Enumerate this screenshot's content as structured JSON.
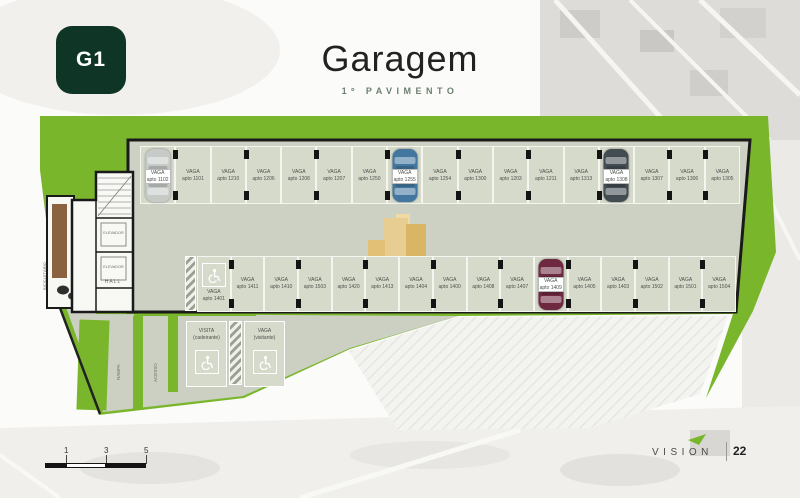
{
  "badge": {
    "label": "G1"
  },
  "header": {
    "title": "Garagem",
    "subtitle": "1º PAVIMENTO"
  },
  "plan": {
    "spot_word": "VAGA",
    "apto_prefix": "apto",
    "annex": {
      "elevator_label": "ELEVADOR",
      "hall_label": "HALL",
      "dock_label": "BICICLETÁRIO"
    },
    "lane_labels": [
      "RAMPA",
      "ACESSO"
    ],
    "rows": {
      "top": [
        {
          "apto": "1102",
          "car": "silver"
        },
        {
          "apto": "1101"
        },
        {
          "apto": "1210"
        },
        {
          "apto": "1206"
        },
        {
          "apto": "1208"
        },
        {
          "apto": "1207"
        },
        {
          "apto": "1250"
        },
        {
          "apto": "1255",
          "car": "blue"
        },
        {
          "apto": "1254"
        },
        {
          "apto": "1300"
        },
        {
          "apto": "1203"
        },
        {
          "apto": "1211"
        },
        {
          "apto": "1313"
        },
        {
          "apto": "1308",
          "car": "dark"
        },
        {
          "apto": "1307"
        },
        {
          "apto": "1306"
        },
        {
          "apto": "1305"
        }
      ],
      "bottom": [
        {
          "apto": "1401",
          "accessible": true
        },
        {
          "apto": "1411"
        },
        {
          "apto": "1410"
        },
        {
          "apto": "1503"
        },
        {
          "apto": "1420"
        },
        {
          "apto": "1413"
        },
        {
          "apto": "1404"
        },
        {
          "apto": "1400"
        },
        {
          "apto": "1408"
        },
        {
          "apto": "1407"
        },
        {
          "apto": "1409",
          "car": "maroon"
        },
        {
          "apto": "1405"
        },
        {
          "apto": "1403"
        },
        {
          "apto": "1502"
        },
        {
          "apto": "1501"
        },
        {
          "apto": "1504"
        }
      ]
    },
    "visitor_spots": [
      {
        "line1": "VISITA",
        "line2": "(cadeirante)",
        "icon": "wheelchair-icon"
      },
      {
        "line1": "VAGA",
        "line2": "(visitante)",
        "icon": "wheelchair-icon"
      }
    ]
  },
  "colors": {
    "green": "#7ab62c",
    "badge_green": "#0f3526",
    "pavement": "#cdd2c5",
    "spot_fill": "#d5dacb",
    "cars": {
      "silver": "#c6cbc8",
      "blue": "#44779f",
      "dark": "#434c52",
      "maroon": "#6e2840"
    }
  },
  "footer": {
    "brand": "VISION",
    "page": "22",
    "scale_ticks": [
      "1",
      "3",
      "5"
    ]
  }
}
